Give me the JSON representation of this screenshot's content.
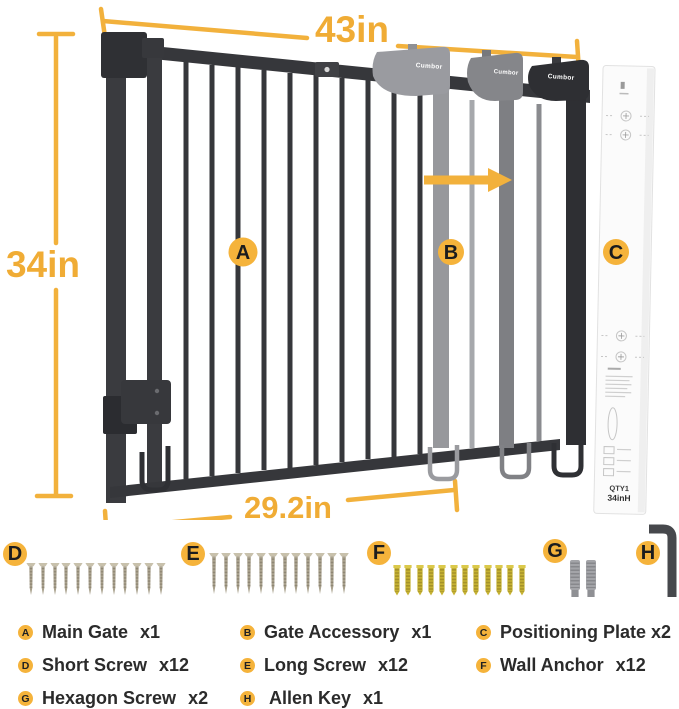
{
  "colors": {
    "accent_badge": "#F5B33B",
    "dimension": "#F2B13C",
    "gate_dark": "#36373B",
    "ghost_light": "#97989C",
    "ghost_mid": "#7E7F83",
    "anchor_gold": "#C6B233"
  },
  "diagram": {
    "brand": "Cumbor",
    "dim_top": "43in",
    "dim_left": "34in",
    "dim_bottom": "29.2in",
    "plate_qty": "QTY1",
    "plate_size": "34inH"
  },
  "legend": {
    "items": [
      {
        "letter": "A",
        "name": "Main Gate",
        "qty": "x1"
      },
      {
        "letter": "B",
        "name": "Gate Accessory",
        "qty": "x1"
      },
      {
        "letter": "C",
        "name": "Positioning Plate",
        "qty": "x2"
      },
      {
        "letter": "D",
        "name": "Short Screw",
        "qty": "x12"
      },
      {
        "letter": "E",
        "name": "Long Screw",
        "qty": "x12"
      },
      {
        "letter": "F",
        "name": "Wall Anchor",
        "qty": "x12"
      },
      {
        "letter": "G",
        "name": "Hexagon Screw",
        "qty": "x2"
      },
      {
        "letter": "H",
        "name": "Allen Key",
        "qty": "x1"
      }
    ]
  }
}
